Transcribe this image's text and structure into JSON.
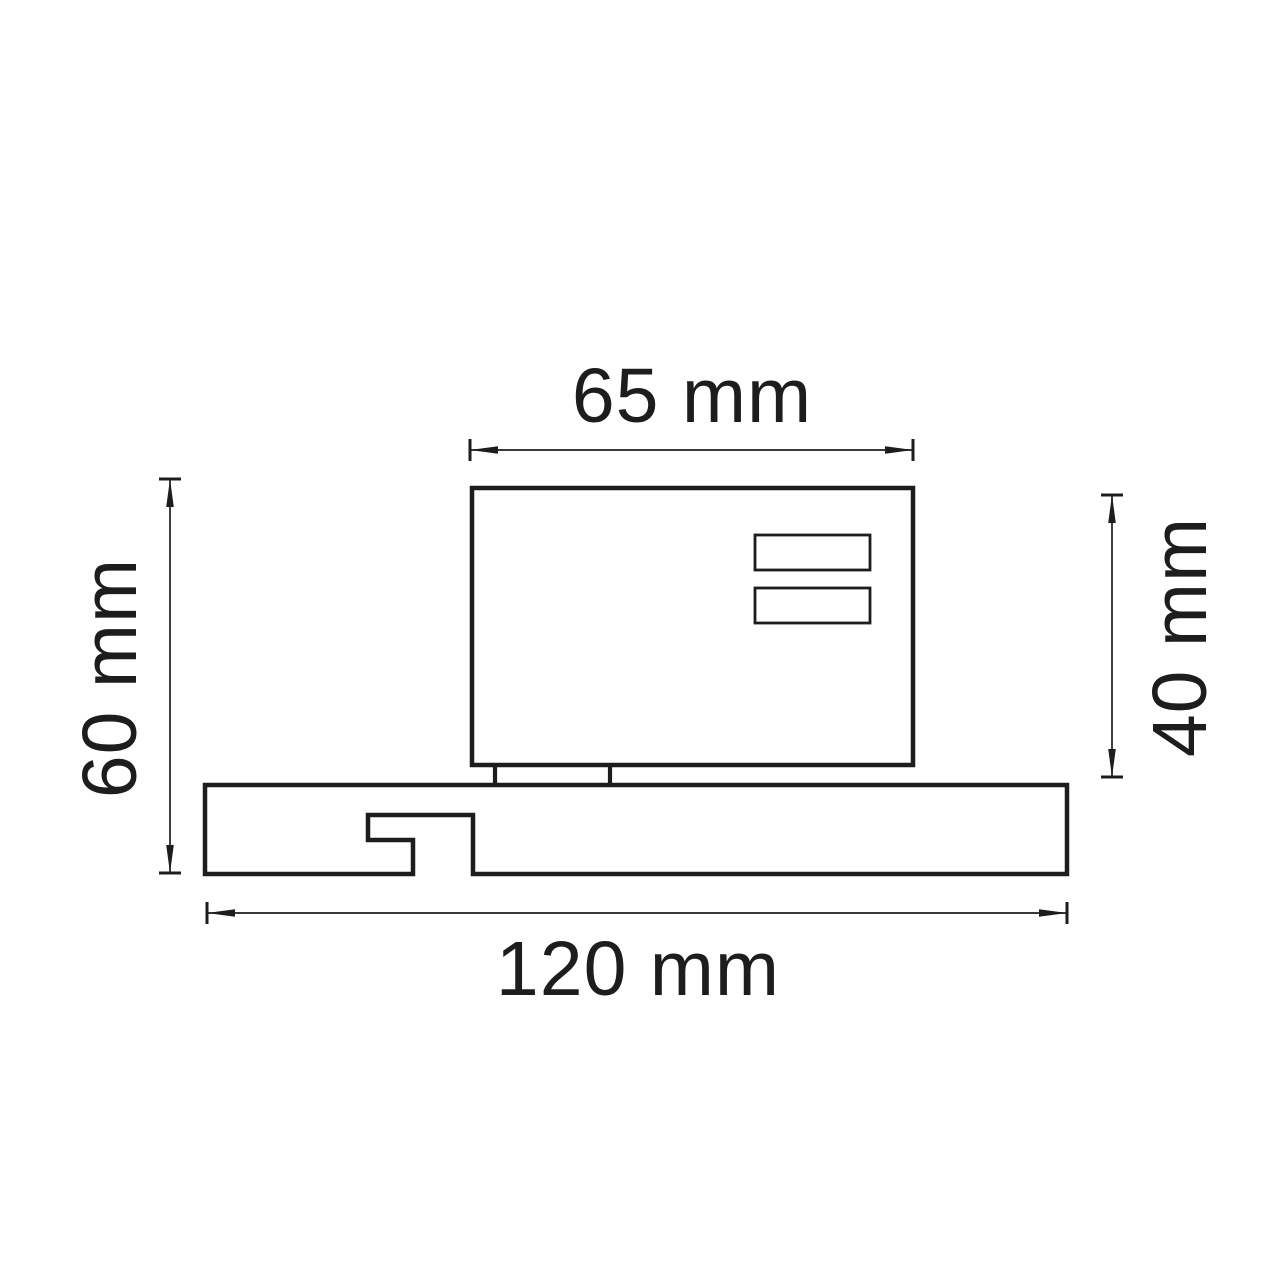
{
  "drawing": {
    "kind": "technical dimension drawing (track light adapter side view)",
    "background_color": "#ffffff",
    "line_color": "#1d1d1b",
    "unit": "mm",
    "dimensions": {
      "top": {
        "label": "65 mm",
        "value": 65,
        "measures": "body width"
      },
      "right": {
        "label": "40 mm",
        "value": 40,
        "measures": "body height"
      },
      "left": {
        "label": "60 mm",
        "value": 60,
        "measures": "overall height"
      },
      "bottom": {
        "label": "120 mm",
        "value": 120,
        "measures": "base width"
      }
    }
  }
}
